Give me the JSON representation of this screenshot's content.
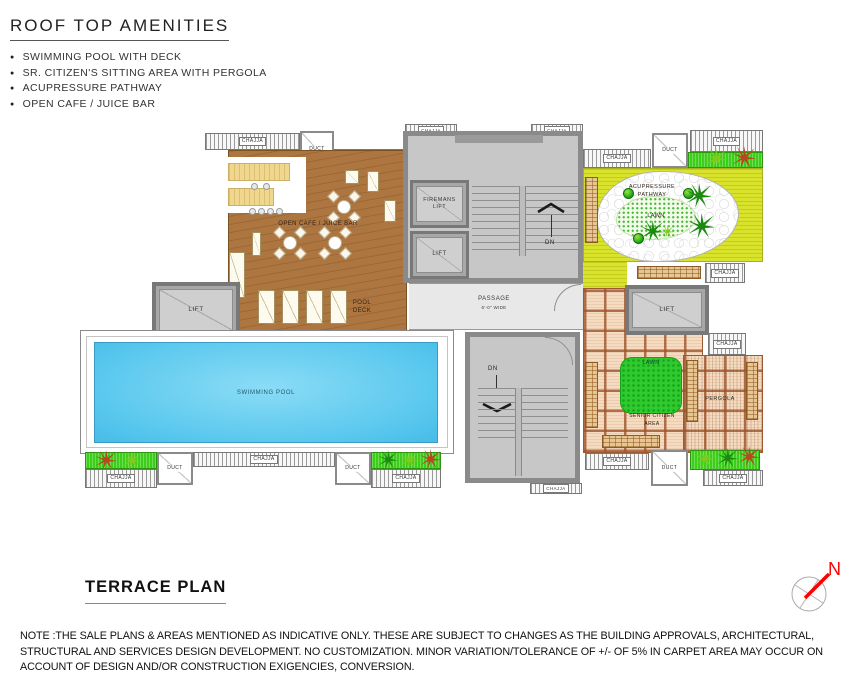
{
  "header": {
    "title": "ROOF TOP AMENITIES",
    "bullets": [
      "SWIMMING POOL WITH DECK",
      "SR. CITIZEN'S SITTING AREA WITH PERGOLA",
      "ACUPRESSURE PATHWAY",
      "OPEN CAFE / JUICE BAR"
    ]
  },
  "plan": {
    "labels": {
      "chajja": "CHAJJA",
      "duct": "DUCT",
      "lift": "LIFT",
      "firemans_lift": "FIREMANS LIFT",
      "open_cafe": "OPEN CAFE / JUICE BAR",
      "pool_deck": "POOL DECK",
      "swimming_pool": "SWIMMING POOL",
      "passage": "PASSAGE",
      "passage_width": "6'-0\" WIDE",
      "dn": "DN",
      "acupressure_pathway": "ACUPRESSURE PATHWAY",
      "lawn": "LAWN",
      "senior_citizen_area": "SENIOR CITIZEN AREA",
      "pergola": "PERGOLA"
    }
  },
  "footer": {
    "plan_title": "TERRACE  PLAN",
    "north_label": "N",
    "note": "NOTE :THE SALE PLANS & AREAS MENTIONED AS INDICATIVE ONLY. THESE ARE SUBJECT TO CHANGES AS THE BUILDING APPROVALS, ARCHITECTURAL, STRUCTURAL AND  SERVICES DESIGN DEVELOPMENT. NO CUSTOMIZATION. MINOR VARIATION/TOLERANCE OF +/- OF 5% IN CARPET AREA MAY OCCUR ON ACCOUNT OF DESIGN AND/OR CONSTRUCTION EXIGENCIES, CONVERSION."
  },
  "colors": {
    "pool": "#5ac8ee",
    "wood": "#ad753f",
    "acupressure_yellow": "#d9e32b",
    "grass_green": "#3bcf1a",
    "lawn_green": "#2ecb2e",
    "tile": "#f5dcc0",
    "north_red": "#ff0000"
  }
}
